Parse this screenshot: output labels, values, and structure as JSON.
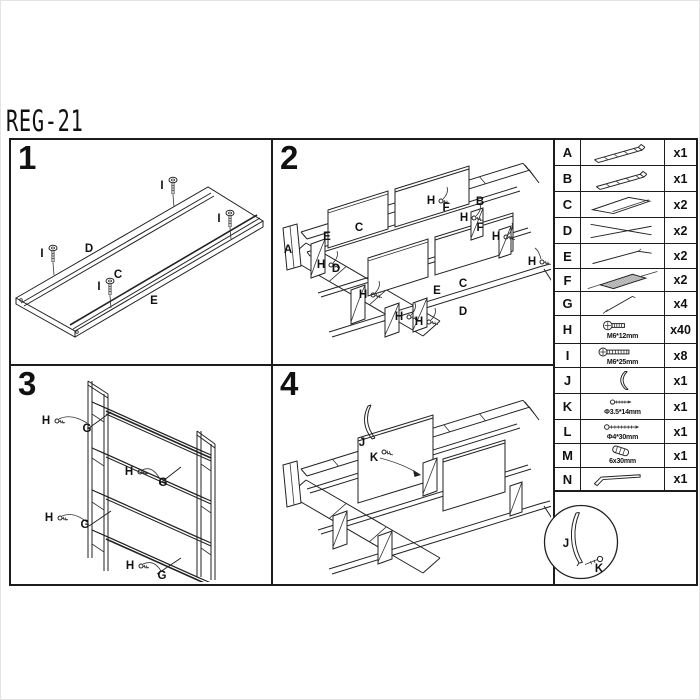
{
  "title": "REG-21",
  "panels": {
    "p1": {
      "number": "1",
      "shelf_labels": [
        "D",
        "C",
        "E"
      ],
      "screw_labels": [
        "I",
        "I",
        "I",
        "I"
      ]
    },
    "p2": {
      "number": "2",
      "labels": [
        "A",
        "E",
        "C",
        "H",
        "D",
        "H",
        "H",
        "H",
        "E",
        "C",
        "D",
        "B",
        "H",
        "F",
        "H",
        "F",
        "H",
        "H"
      ]
    },
    "p3": {
      "number": "3",
      "labels": [
        "H",
        "G",
        "H",
        "G",
        "H",
        "G",
        "H",
        "G"
      ]
    },
    "p4": {
      "number": "4",
      "labels": [
        "J",
        "K"
      ]
    }
  },
  "detail_view": {
    "labels": [
      "J",
      "K"
    ]
  },
  "parts": {
    "rows": [
      {
        "id": "A",
        "qty": "x1",
        "icon": "ladder-frame"
      },
      {
        "id": "B",
        "qty": "x1",
        "icon": "ladder-frame"
      },
      {
        "id": "C",
        "qty": "x2",
        "icon": "shelf-panel"
      },
      {
        "id": "D",
        "qty": "x2",
        "icon": "rail-pair"
      },
      {
        "id": "E",
        "qty": "x2",
        "icon": "rail"
      },
      {
        "id": "F",
        "qty": "x2",
        "icon": "mesh-shelf"
      },
      {
        "id": "G",
        "qty": "x4",
        "icon": "support-rod"
      },
      {
        "id": "H",
        "qty": "x40",
        "icon": "bolt",
        "spec": "M6*12mm"
      },
      {
        "id": "I",
        "qty": "x8",
        "icon": "bolt-long",
        "spec": "M6*25mm"
      },
      {
        "id": "J",
        "qty": "x1",
        "icon": "curved-bracket"
      },
      {
        "id": "K",
        "qty": "x1",
        "icon": "screw-small",
        "spec": "Φ3.5*14mm"
      },
      {
        "id": "L",
        "qty": "x1",
        "icon": "screw-long",
        "spec": "Φ4*30mm"
      },
      {
        "id": "M",
        "qty": "x1",
        "icon": "dowel",
        "spec": "6x30mm"
      },
      {
        "id": "N",
        "qty": "x1",
        "icon": "allen-key"
      }
    ]
  }
}
